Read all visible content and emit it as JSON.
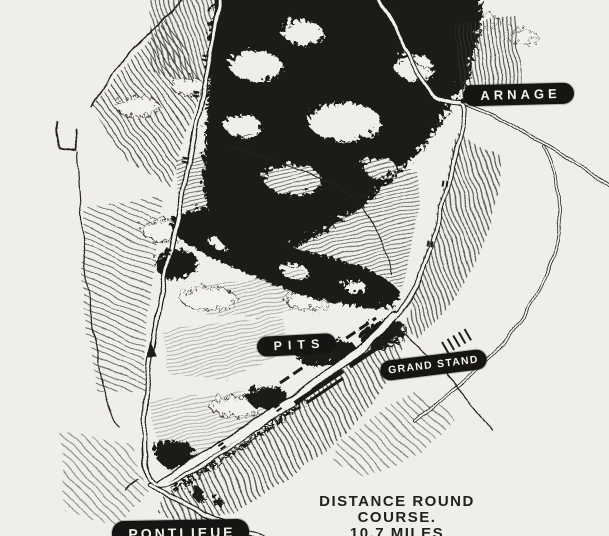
{
  "figure": {
    "kind": "hand-drawn race course map",
    "labels": [
      {
        "id": "arnage",
        "text": "ARNAGE"
      },
      {
        "id": "pits",
        "text": "PITS"
      },
      {
        "id": "grand_stand",
        "text": "GRAND STAND"
      },
      {
        "id": "pontlieue",
        "text": "PONTLIEUE"
      }
    ],
    "caption": {
      "line1": "DISTANCE ROUND",
      "line2": "COURSE.",
      "line3": "10.7 MILES"
    },
    "colors": {
      "paper": "#f2f1ec",
      "ink": "#1d1b19",
      "label_bg": "#171514",
      "label_text": "#f4f2ec"
    }
  }
}
